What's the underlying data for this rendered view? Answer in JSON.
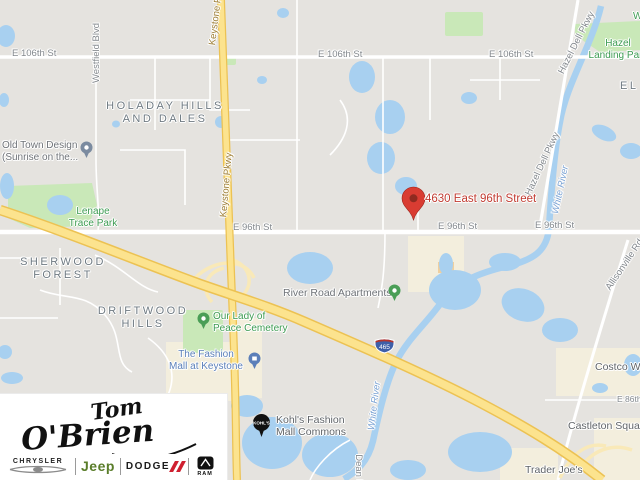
{
  "colors": {
    "map_background": "#e5e3df",
    "water_blue": "#a8d0f0",
    "park_green": "#c9e8b8",
    "commercial_beige": "#f3eedd",
    "highway_fill_yellow": "#fce38e",
    "highway_casing": "#ecc253",
    "marker_red": "#d93c32",
    "address_text_red": "#c13b31",
    "poi_green_text": "#3d9b52",
    "mall_blue_text": "#5b7fb9",
    "interstate_shield_blue": "#3e5fa8",
    "interstate_shield_red": "#b5342c",
    "jeep_green": "#5a7d2a",
    "dodge_red": "#cf2030"
  },
  "marker": {
    "address": "4630 East 96th Street"
  },
  "neighborhoods": {
    "holaday_line1": "HOLADAY HILLS",
    "holaday_line2": "AND DALES",
    "sherwood_line1": "SHERWOOD",
    "sherwood_line2": "FOREST",
    "driftwood_line1": "DRIFTWOOD",
    "driftwood_line2": "HILLS",
    "edge_fragment_right": "EL",
    "edge_fragment_top_right": "W"
  },
  "streets": {
    "e_106th_st": "E 106th St",
    "e_96th_st": "E 96th St",
    "e_86th_st": "E 86th St",
    "keystone_pkwy": "Keystone Pkwy",
    "hazel_dell_pkwy": "Hazel Dell Pkwy",
    "allisonville_rd": "Allisonville Rd",
    "dean_rd": "Dean Rd",
    "westfield_blvd": "Westfield Blvd",
    "white_river": "White River"
  },
  "pois": {
    "old_town_line1": "Old Town Design",
    "old_town_line2": "(Sunrise on the...",
    "lenape_line1": "Lenape",
    "lenape_line2": "Trace Park",
    "hazel_landing_line1": "Hazel",
    "hazel_landing_line2": "Landing Park",
    "our_lady_line1": "Our Lady of",
    "our_lady_line2": "Peace Cemetery",
    "fashion_mall_line1": "The Fashion",
    "fashion_mall_line2": "Mall at Keystone",
    "river_road_apartments": "River Road Apartments",
    "kohls_line1": "Kohl's Fashion",
    "kohls_line2": "Mall Commons",
    "costco": "Costco Wholesale",
    "castleton_square": "Castleton Square",
    "trader_joes": "Trader Joe's",
    "interstate_shield": "465"
  },
  "logo": {
    "dealer_line1": "Tom",
    "dealer_line2": "O'Brien",
    "brand_chrysler": "CHRYSLER",
    "brand_jeep": "Jeep",
    "brand_dodge": "DODGE",
    "brand_ram": "RAM"
  }
}
